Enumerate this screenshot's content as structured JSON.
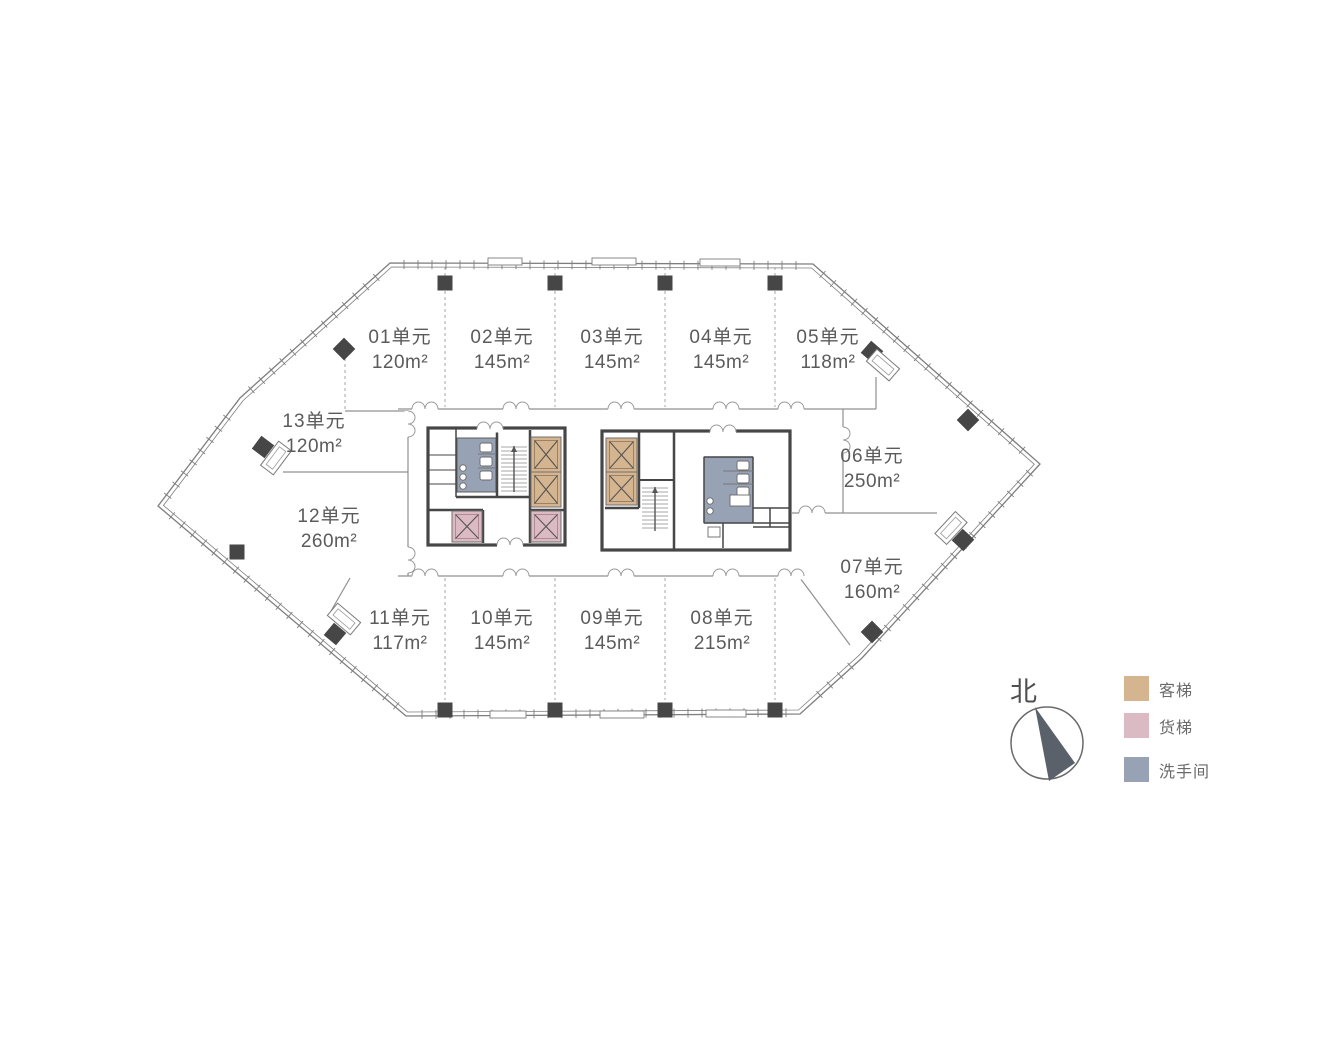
{
  "compass": {
    "label": "北"
  },
  "legend": {
    "items": [
      {
        "key": "passenger-elevator",
        "label": "客梯",
        "color": "#d4b58f"
      },
      {
        "key": "freight-elevator",
        "label": "货梯",
        "color": "#dcbac3"
      },
      {
        "key": "restroom",
        "label": "洗手间",
        "color": "#97a2b4"
      }
    ]
  },
  "units": [
    {
      "id": "01",
      "name": "01单元",
      "area": "120m²",
      "cx": 400,
      "top": 325
    },
    {
      "id": "02",
      "name": "02单元",
      "area": "145m²",
      "cx": 502,
      "top": 325
    },
    {
      "id": "03",
      "name": "03单元",
      "area": "145m²",
      "cx": 612,
      "top": 325
    },
    {
      "id": "04",
      "name": "04单元",
      "area": "145m²",
      "cx": 721,
      "top": 325
    },
    {
      "id": "05",
      "name": "05单元",
      "area": "118m²",
      "cx": 828,
      "top": 325
    },
    {
      "id": "06",
      "name": "06单元",
      "area": "250m²",
      "cx": 872,
      "top": 444
    },
    {
      "id": "07",
      "name": "07单元",
      "area": "160m²",
      "cx": 872,
      "top": 555
    },
    {
      "id": "08",
      "name": "08单元",
      "area": "215m²",
      "cx": 722,
      "top": 606
    },
    {
      "id": "09",
      "name": "09单元",
      "area": "145m²",
      "cx": 612,
      "top": 606
    },
    {
      "id": "10",
      "name": "10单元",
      "area": "145m²",
      "cx": 502,
      "top": 606
    },
    {
      "id": "11",
      "name": "11单元",
      "area": "117m²",
      "cx": 400,
      "top": 606
    },
    {
      "id": "12",
      "name": "12单元",
      "area": "260m²",
      "cx": 329,
      "top": 504
    },
    {
      "id": "13",
      "name": "13单元",
      "area": "120m²",
      "cx": 314,
      "top": 409
    }
  ],
  "plan": {
    "w": 1323,
    "h": 1058,
    "colors": {
      "outline": "#7e7e7e",
      "wall": "#464646",
      "thin": "#909090",
      "dashed": "#a6a6a6",
      "tan": "#d4b58f",
      "tanLine": "#9c8262",
      "pink": "#dcbac3",
      "pinkLine": "#b08b97",
      "blue": "#97a2b4",
      "fixture": "#6a6a6a",
      "needle": "#5b616b",
      "circle": "#6a6a6a"
    },
    "outline": [
      [
        158,
        506
      ],
      [
        240,
        398
      ],
      [
        390,
        263
      ],
      [
        813,
        264
      ],
      [
        1040,
        464
      ],
      [
        862,
        658
      ],
      [
        800,
        714
      ],
      [
        406,
        716
      ]
    ],
    "tick": {
      "spacing": 14,
      "outer": 3,
      "inner": 6
    },
    "panels": [
      [
        488,
        258,
        34,
        7
      ],
      [
        592,
        258,
        44,
        7
      ],
      [
        700,
        259,
        40,
        7
      ],
      [
        490,
        711,
        36,
        7
      ],
      [
        600,
        711,
        44,
        7
      ],
      [
        706,
        710,
        40,
        7
      ]
    ],
    "dashed": [
      [
        445,
        267,
        445,
        407
      ],
      [
        555,
        267,
        555,
        407
      ],
      [
        665,
        267,
        665,
        407
      ],
      [
        775,
        267,
        775,
        407
      ],
      [
        445,
        578,
        445,
        700
      ],
      [
        555,
        578,
        555,
        700
      ],
      [
        665,
        578,
        665,
        700
      ],
      [
        775,
        578,
        775,
        700
      ],
      [
        345,
        352,
        345,
        410
      ]
    ],
    "thin": [
      [
        398,
        409,
        876,
        409
      ],
      [
        398,
        576,
        800,
        576
      ],
      [
        408,
        411,
        408,
        576
      ],
      [
        843,
        409,
        843,
        513
      ],
      [
        792,
        513,
        937,
        513
      ],
      [
        876,
        377,
        876,
        409
      ],
      [
        345,
        411,
        408,
        411
      ],
      [
        283,
        472,
        408,
        472
      ],
      [
        350,
        578,
        331,
        611
      ],
      [
        800,
        578,
        850,
        645
      ]
    ],
    "doors": [
      {
        "x": 425,
        "y": 409,
        "o": "h"
      },
      {
        "x": 516,
        "y": 409,
        "o": "h"
      },
      {
        "x": 621,
        "y": 409,
        "o": "h"
      },
      {
        "x": 726,
        "y": 409,
        "o": "h"
      },
      {
        "x": 791,
        "y": 409,
        "o": "h"
      },
      {
        "x": 425,
        "y": 576,
        "o": "h"
      },
      {
        "x": 516,
        "y": 576,
        "o": "h"
      },
      {
        "x": 621,
        "y": 576,
        "o": "h"
      },
      {
        "x": 726,
        "y": 576,
        "o": "h"
      },
      {
        "x": 791,
        "y": 576,
        "o": "h"
      },
      {
        "x": 408,
        "y": 424,
        "o": "v"
      },
      {
        "x": 408,
        "y": 560,
        "o": "v"
      },
      {
        "x": 843,
        "y": 440,
        "o": "v"
      },
      {
        "x": 812,
        "y": 513,
        "o": "h"
      },
      {
        "x": 510,
        "y": 545,
        "o": "h"
      },
      {
        "x": 490,
        "y": 429,
        "o": "h"
      },
      {
        "x": 723,
        "y": 432,
        "o": "h"
      }
    ],
    "cores": [
      {
        "rect": [
          428,
          428,
          137,
          117
        ],
        "rooms": [
          {
            "c": "blue",
            "r": [
              457,
              438,
              39,
              54
            ]
          }
        ],
        "walls": [
          [
            497,
            430,
            497,
            497,
            2.5
          ],
          [
            530,
            430,
            530,
            543,
            2.5
          ],
          [
            456,
            497,
            530,
            497,
            2.5
          ],
          [
            428,
            510,
            483,
            510,
            2.5
          ],
          [
            483,
            510,
            483,
            543,
            2.5
          ],
          [
            531,
            510,
            565,
            510,
            2.5
          ],
          [
            456,
            428,
            456,
            497,
            1.5
          ],
          [
            428,
            455,
            456,
            455,
            1
          ],
          [
            428,
            470,
            456,
            470,
            1
          ],
          [
            428,
            484,
            456,
            484,
            1
          ]
        ],
        "elevators": [
          {
            "r": [
              531,
              437,
              30,
              35
            ],
            "c": "tan"
          },
          {
            "r": [
              531,
              472,
              30,
              35
            ],
            "c": "tan"
          },
          {
            "r": [
              452,
              511,
              30,
              31
            ],
            "c": "pink"
          },
          {
            "r": [
              531,
              511,
              30,
              31
            ],
            "c": "pink"
          }
        ],
        "stairs": [
          {
            "r": [
              500,
              444,
              28,
              50
            ]
          }
        ],
        "toilets": [
          [
            480,
            443
          ],
          [
            480,
            457
          ],
          [
            480,
            471
          ]
        ],
        "stallLines": [
          [
            478,
            454,
            496,
            454
          ],
          [
            478,
            468,
            496,
            468
          ]
        ],
        "sinks": [
          [
            463,
            468
          ],
          [
            463,
            477
          ],
          [
            463,
            486
          ]
        ],
        "extras": []
      },
      {
        "rect": [
          602,
          431,
          188,
          119
        ],
        "rooms": [
          {
            "c": "blue",
            "r": [
              704,
              457,
              49,
              66
            ]
          }
        ],
        "walls": [
          [
            639,
            431,
            639,
            508,
            2.5
          ],
          [
            674,
            431,
            674,
            550,
            2.5
          ],
          [
            605,
            508,
            639,
            508,
            2.5
          ],
          [
            639,
            480,
            674,
            480,
            2
          ],
          [
            704,
            523,
            790,
            523,
            1.5
          ],
          [
            723,
            523,
            723,
            548,
            1.5
          ],
          [
            753,
            508,
            790,
            508,
            1.5
          ],
          [
            770,
            508,
            770,
            527,
            1.5
          ],
          [
            753,
            527,
            790,
            527,
            1.5
          ],
          [
            704,
            457,
            753,
            457,
            1.5
          ],
          [
            704,
            457,
            704,
            523,
            1.5
          ],
          [
            753,
            457,
            753,
            523,
            1.5
          ]
        ],
        "elevators": [
          {
            "r": [
              606,
              438,
              31,
              34
            ],
            "c": "tan"
          },
          {
            "r": [
              606,
              472,
              31,
              33
            ],
            "c": "tan"
          }
        ],
        "stairs": [
          {
            "r": [
              641,
              485,
              28,
              48
            ]
          }
        ],
        "toilets": [
          [
            737,
            461
          ],
          [
            737,
            474
          ],
          [
            737,
            487
          ]
        ],
        "stallLines": [
          [
            723,
            471,
            753,
            471
          ],
          [
            723,
            484,
            753,
            484
          ]
        ],
        "sinks": [
          [
            710,
            501
          ],
          [
            710,
            511
          ]
        ],
        "extras": [
          [
            730,
            495,
            20,
            11
          ],
          [
            708,
            527,
            12,
            10
          ]
        ]
      }
    ],
    "columns": [
      [
        445,
        283
      ],
      [
        555,
        283
      ],
      [
        665,
        283
      ],
      [
        775,
        283
      ],
      [
        445,
        710
      ],
      [
        555,
        710
      ],
      [
        665,
        710
      ],
      [
        775,
        710
      ],
      [
        237,
        552
      ]
    ],
    "diamonds": [
      [
        344,
        349
      ],
      [
        968,
        420
      ],
      [
        872,
        632
      ]
    ],
    "canopies": [
      {
        "sq": [
          263,
          447
        ],
        "rc": [
          276,
          458
        ],
        "a": 127
      },
      {
        "sq": [
          335,
          634
        ],
        "rc": [
          344,
          619
        ],
        "a": 40
      },
      {
        "sq": [
          872,
          352
        ],
        "rc": [
          883,
          365
        ],
        "a": 41
      },
      {
        "sq": [
          963,
          540
        ],
        "rc": [
          951,
          528
        ],
        "a": 133
      }
    ],
    "compass": {
      "cx": 1047,
      "cy": 743,
      "r": 36,
      "needle": [
        [
          1035,
          707
        ],
        [
          1049,
          781
        ],
        [
          1075,
          763
        ]
      ]
    }
  }
}
